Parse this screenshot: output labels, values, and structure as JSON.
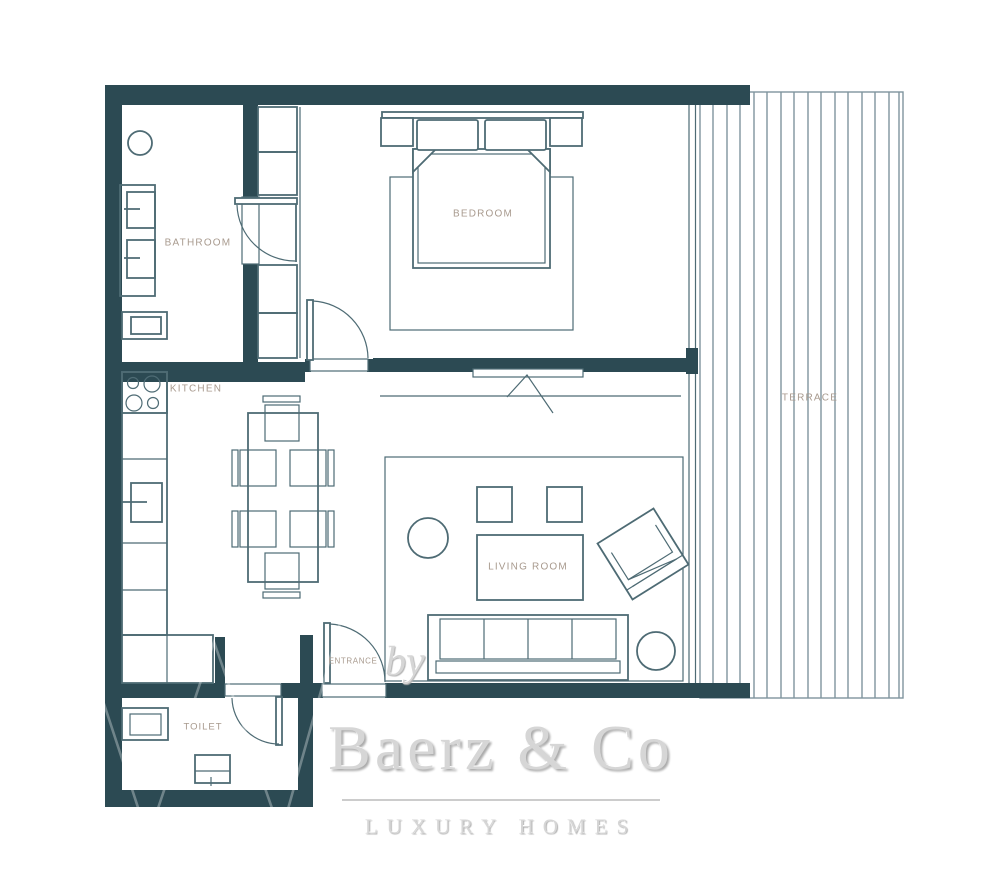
{
  "colors": {
    "background": "#ffffff",
    "wall": "#2c4a53",
    "line": "#4e6b74",
    "terrace-line": "#7f959e",
    "label": "#a89a8e",
    "logo": "#d6d6d6",
    "logo-rule": "#cccccc"
  },
  "rooms": {
    "bathroom": {
      "label": "BATHROOM"
    },
    "bedroom": {
      "label": "BEDROOM"
    },
    "kitchen": {
      "label": "KITCHEN"
    },
    "living_room": {
      "label": "LIVING ROOM"
    },
    "terrace": {
      "label": "TERRACE"
    },
    "entrance": {
      "label": "ENTRANCE"
    },
    "toilet": {
      "label": "TOILET"
    }
  },
  "logo": {
    "prefix": "by",
    "brand": "Baerz & Co",
    "tagline": "LUXURY HOMES"
  },
  "symbols": [
    "terrace-decking",
    "double-bed",
    "wardrobe",
    "vanity-two-sinks",
    "wall-toilet",
    "ceiling-light",
    "kitchen-hob",
    "kitchen-sink",
    "kitchen-counter",
    "dining-table-six-chairs",
    "rug",
    "pouf",
    "side-table-round",
    "coffee-table",
    "armchair",
    "sofa-four-seat",
    "floor-lamp",
    "washbasin",
    "door-swing",
    "window"
  ]
}
